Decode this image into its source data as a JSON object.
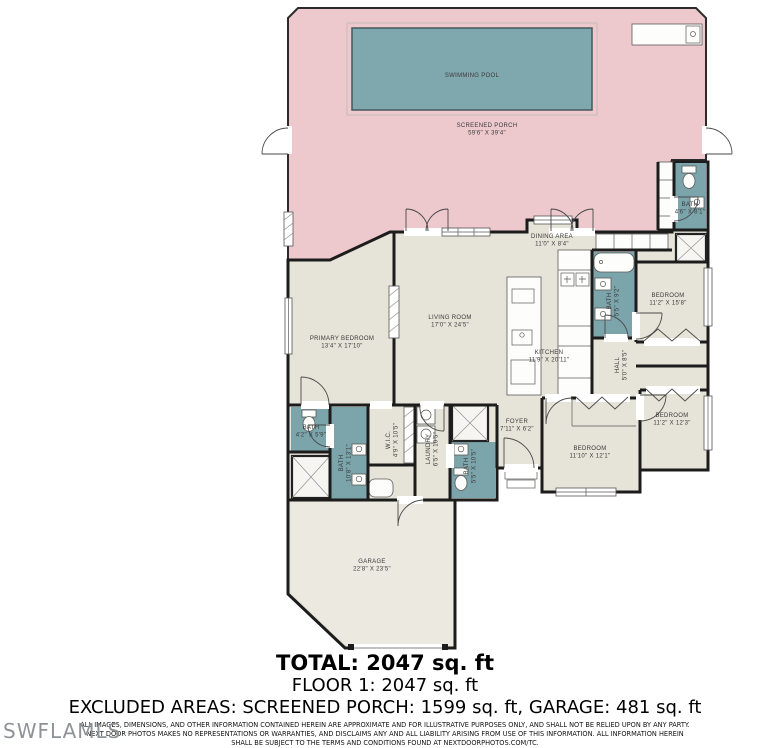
{
  "page": {
    "watermark": "SWFLAMLS"
  },
  "summary": {
    "total": "TOTAL: 2047 sq. ft",
    "floor1": "FLOOR 1: 2047 sq. ft",
    "excluded": "EXCLUDED AREAS: SCREENED PORCH: 1599 sq. ft, GARAGE: 481 sq. ft",
    "disclaimer_line1": "ALL IMAGES, DIMENSIONS, AND OTHER INFORMATION CONTAINED HEREIN ARE APPROXIMATE AND FOR ILLUSTRATIVE PURPOSES ONLY, AND SHALL NOT BE RELIED UPON BY ANY PARTY.",
    "disclaimer_line2": "NEXT DOOR PHOTOS MAKES NO REPRESENTATIONS OR WARRANTIES, AND DISCLAIMS ANY AND ALL LIABILITY ARISING FROM USE OF THIS INFORMATION. ALL INFORMATION HEREIN",
    "disclaimer_line3": "SHALL BE SUBJECT TO THE TERMS AND CONDITIONS FOUND AT NEXTDOORPHOTOS.COM/TC."
  },
  "floorplan": {
    "colors": {
      "porch": "#edc9ce",
      "pool": "#7fa8ae",
      "floor": "#e6e3d8",
      "bath": "#7ba4ab",
      "wall": "#1c1c1c"
    },
    "rooms": [
      {
        "id": "swimming-pool",
        "name": "SWIMMING POOL",
        "dims": "",
        "x": 472,
        "y": 77,
        "rotate": false
      },
      {
        "id": "screened-porch",
        "name": "SCREENED PORCH",
        "dims": "59'6\" X 39'4\"",
        "x": 487,
        "y": 127,
        "rotate": false
      },
      {
        "id": "dining-area",
        "name": "DINING AREA",
        "dims": "11'0\" X 8'4\"",
        "x": 552,
        "y": 238,
        "rotate": false
      },
      {
        "id": "living-room",
        "name": "LIVING ROOM",
        "dims": "17'0\" X 24'5\"",
        "x": 450,
        "y": 319,
        "rotate": false
      },
      {
        "id": "kitchen",
        "name": "KITCHEN",
        "dims": "11'9\" X 20'11\"",
        "x": 549,
        "y": 354,
        "rotate": false
      },
      {
        "id": "primary-bedroom",
        "name": "PRIMARY BEDROOM",
        "dims": "13'4\" X 17'10\"",
        "x": 342,
        "y": 340,
        "rotate": false
      },
      {
        "id": "bedroom-1",
        "name": "BEDROOM",
        "dims": "11'2\" X 15'8\"",
        "x": 668,
        "y": 297,
        "rotate": false
      },
      {
        "id": "bedroom-2",
        "name": "BEDROOM",
        "dims": "11'2\" X 12'3\"",
        "x": 672,
        "y": 417,
        "rotate": false
      },
      {
        "id": "bedroom-3",
        "name": "BEDROOM",
        "dims": "11'10\" X 12'1\"",
        "x": 590,
        "y": 450,
        "rotate": false
      },
      {
        "id": "bath-2",
        "name": "BATH",
        "dims": "4'6\" X 8'1\"",
        "x": 690,
        "y": 206,
        "rotate": false
      },
      {
        "id": "bath-3",
        "name": "BATH",
        "dims": "5'5\" X 9'2\"",
        "x": 611,
        "y": 301,
        "rotate": true
      },
      {
        "id": "hall",
        "name": "HALL",
        "dims": "5'0\" X 8'5\"",
        "x": 619,
        "y": 365,
        "rotate": true
      },
      {
        "id": "foyer",
        "name": "FOYER",
        "dims": "7'11\" X 6'2\"",
        "x": 517,
        "y": 423,
        "rotate": false
      },
      {
        "id": "laundry",
        "name": "LAUNDRY",
        "dims": "6'5\" X 10'5\"",
        "x": 430,
        "y": 449,
        "rotate": true
      },
      {
        "id": "pool-bath",
        "name": "BATH",
        "dims": "5'5\" X 10'5\"",
        "x": 468,
        "y": 466,
        "rotate": true
      },
      {
        "id": "bath-small",
        "name": "BATH",
        "dims": "4'2\" X 5'9\"",
        "x": 311,
        "y": 429,
        "rotate": false
      },
      {
        "id": "primary-bath",
        "name": "BATH",
        "dims": "10'8\" X 13'1\"",
        "x": 343,
        "y": 463,
        "rotate": true
      },
      {
        "id": "wic",
        "name": "W.I.C.",
        "dims": "4'9\" X 10'5\"",
        "x": 390,
        "y": 440,
        "rotate": true
      },
      {
        "id": "garage",
        "name": "GARAGE",
        "dims": "22'8\" X 23'5\"",
        "x": 372,
        "y": 563,
        "rotate": false
      }
    ]
  }
}
